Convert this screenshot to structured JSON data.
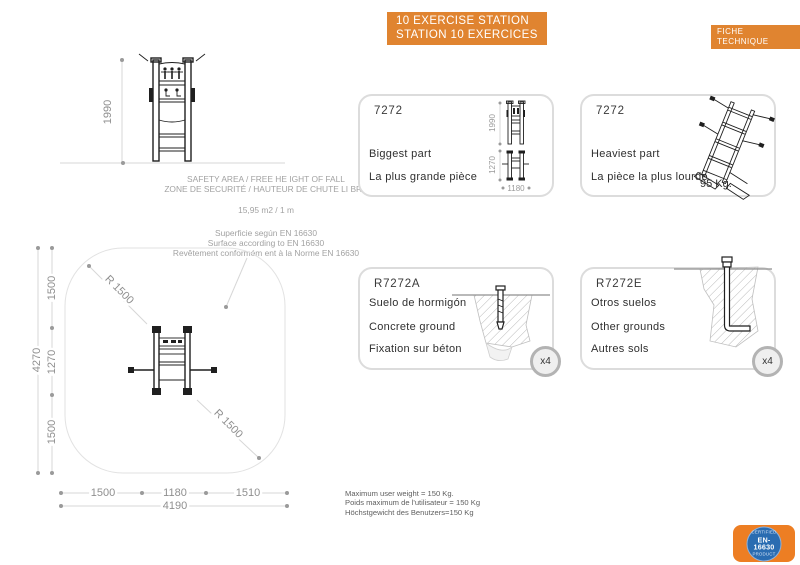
{
  "header": {
    "title_line1": "10 EXERCISE STATION",
    "title_line2": "STATION 10 EXERCICES",
    "fiche": "FICHE TECHNIQUE"
  },
  "colors": {
    "accent_orange": "#E08430",
    "badge_orange": "#ED7E23",
    "badge_blue": "#2A6CB1",
    "dim_gray": "#8F8F8F",
    "card_border": "#DCDCDC"
  },
  "elevation": {
    "height_dim": "1990",
    "safety_line1": "SAFETY AREA / FREE HE IGHT OF  FALL",
    "safety_line2": "ZONE DE SECURITÉ /  HAUTEUR DE CHUTE LI BRE",
    "area_value": "15,95 m2 / 1 m",
    "surface_es": "Superficie según  EN 16630",
    "surface_en": "Surface according to  EN 16630",
    "surface_fr": "Revêtement conformém ent à la Norme  EN 16630"
  },
  "plan": {
    "total_height": "4270",
    "left_segments": [
      "1500",
      "1270",
      "1500"
    ],
    "bottom_segments": [
      "1500",
      "1180",
      "1510"
    ],
    "total_width": "4190",
    "radius_top": "R 1500",
    "radius_bottom": "R 1500"
  },
  "cards": {
    "biggest": {
      "ref": "7272",
      "line_en": "Biggest part",
      "line_fr": "La plus grande pièce",
      "dim_height": "1990",
      "dim_depth": "1270",
      "dim_width": "1180"
    },
    "heaviest": {
      "ref": "7272",
      "line_en": "Heaviest part",
      "line_fr": "La pièce la plus lourde",
      "weight": "95 Kg."
    },
    "concrete": {
      "ref": "R7272A",
      "line_es": "Suelo de  hormigón",
      "line_en": "Concrete ground",
      "line_fr": "Fixation sur béton",
      "qty": "x4"
    },
    "other": {
      "ref": "R7272E",
      "line_es": "Otros suelos",
      "line_en": "Other grounds",
      "line_fr": "Autres sols",
      "qty": "x4"
    }
  },
  "weight_info": {
    "en": "Maximum user weight = 150 Kg.",
    "fr": "Poids maximum de l'utilisateur = 150 Kg",
    "de": "Höchstgewicht des Benutzers=150 Kg"
  },
  "badge": {
    "line1": "CERTIFIED",
    "line2": "EN-16630",
    "line3": "PRODUCT"
  }
}
